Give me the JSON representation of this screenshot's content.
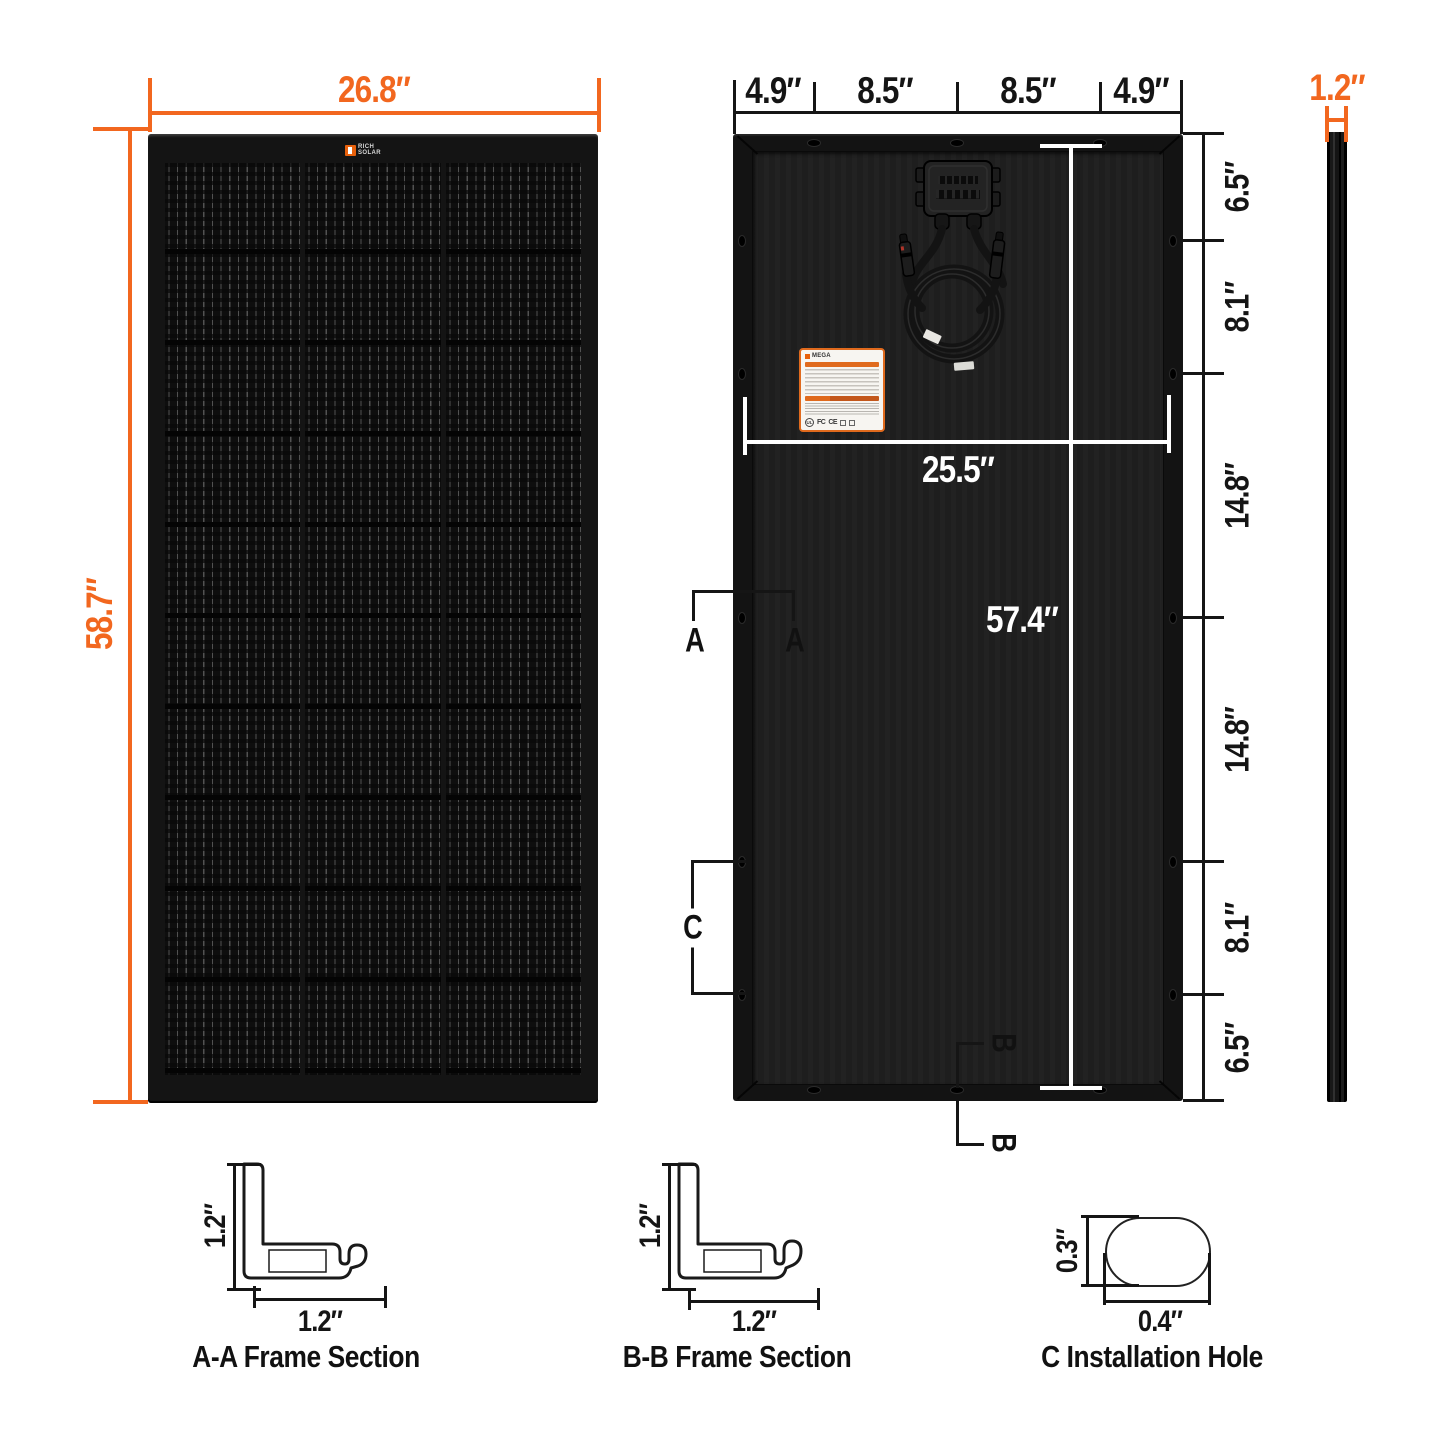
{
  "front_view": {
    "width": "26.8″",
    "height": "58.7″",
    "logo": {
      "line1": "RICH",
      "line2": "SOLAR"
    }
  },
  "back_view": {
    "top_widths": {
      "w1": "4.9″",
      "w2": "8.5″",
      "w3": "8.5″",
      "w4": "4.9″"
    },
    "right_heights": {
      "h1": "6.5″",
      "h2": "8.1″",
      "h3": "14.8″",
      "h4": "14.8″",
      "h5": "8.1″",
      "h6": "6.5″"
    },
    "inner_width": "25.5″",
    "inner_height": "57.4″",
    "marker_a": "A",
    "marker_b": "B",
    "marker_c": "C",
    "spec_label": {
      "brand": "MEGA",
      "cert1": "UL",
      "cert2": "FC",
      "cert3": "CE"
    }
  },
  "side_view": {
    "thickness": "1.2″"
  },
  "sections": {
    "aa": {
      "caption": "A-A Frame Section",
      "height": "1.2″",
      "width": "1.2″"
    },
    "bb": {
      "caption": "B-B Frame Section",
      "height": "1.2″",
      "width": "1.2″"
    },
    "c": {
      "caption": "C Installation Hole",
      "height": "0.3″",
      "width": "0.4″"
    }
  },
  "colors": {
    "accent": "#F2671F",
    "dim_black": "#151515",
    "dim_white": "#ffffff"
  }
}
